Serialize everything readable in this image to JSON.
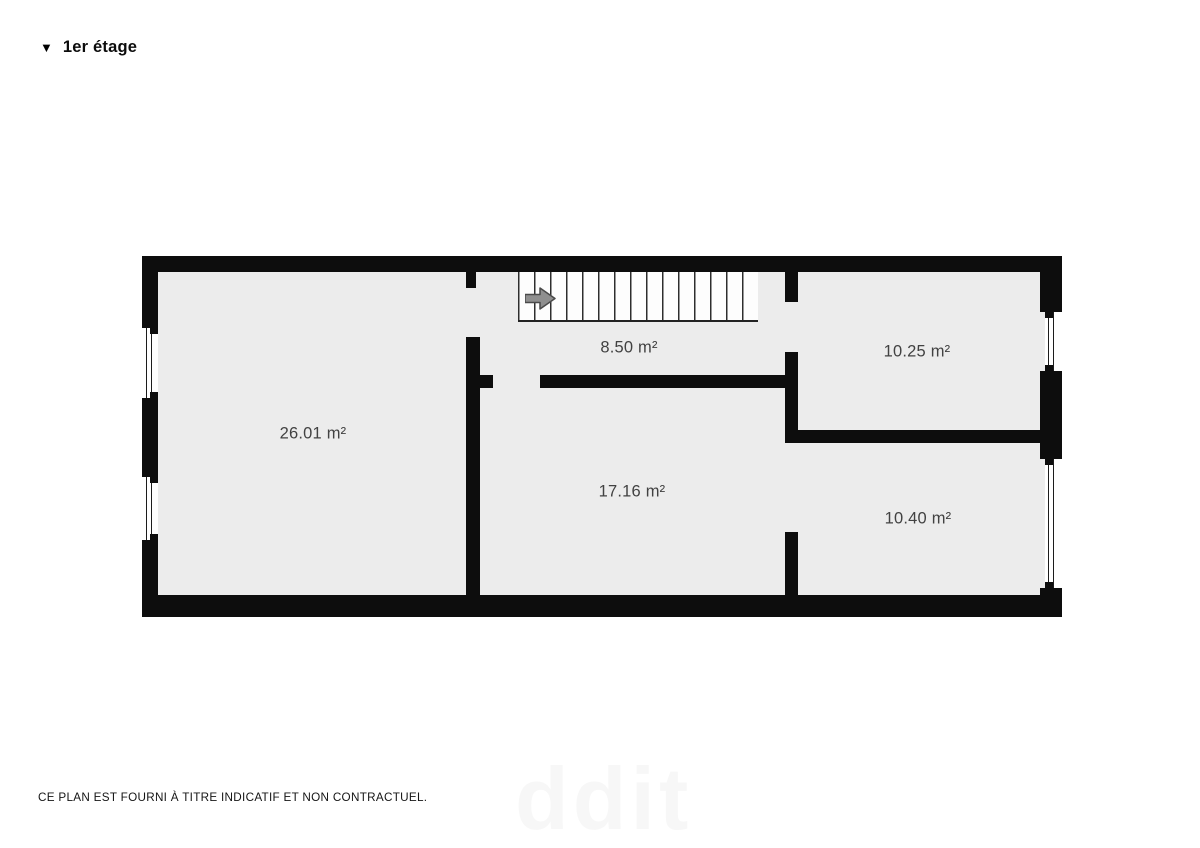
{
  "header": {
    "marker": "▼",
    "title": "1er étage"
  },
  "floor_plan": {
    "rooms": [
      {
        "id": "room-left",
        "area": "26.01 m²"
      },
      {
        "id": "hallway-stairs",
        "area": "8.50 m²"
      },
      {
        "id": "room-top-right",
        "area": "10.25 m²"
      },
      {
        "id": "room-middle",
        "area": "17.16 m²"
      },
      {
        "id": "room-bottom-right",
        "area": "10.40 m²"
      }
    ],
    "stairs": {
      "icon": "arrow-right-icon",
      "direction": "right"
    },
    "window_count": 4
  },
  "footer": {
    "disclaimer": "CE PLAN EST FOURNI À TITRE INDICATIF ET NON CONTRACTUEL."
  },
  "watermark": {
    "text": "ddit"
  },
  "colors": {
    "wall": "#0d0d0d",
    "floor": "#ececec",
    "stairs_background": "#fdfdfd",
    "label_text": "#424242",
    "arrow_fill": "#8f8f8f",
    "watermark": "#f7f7f7"
  }
}
